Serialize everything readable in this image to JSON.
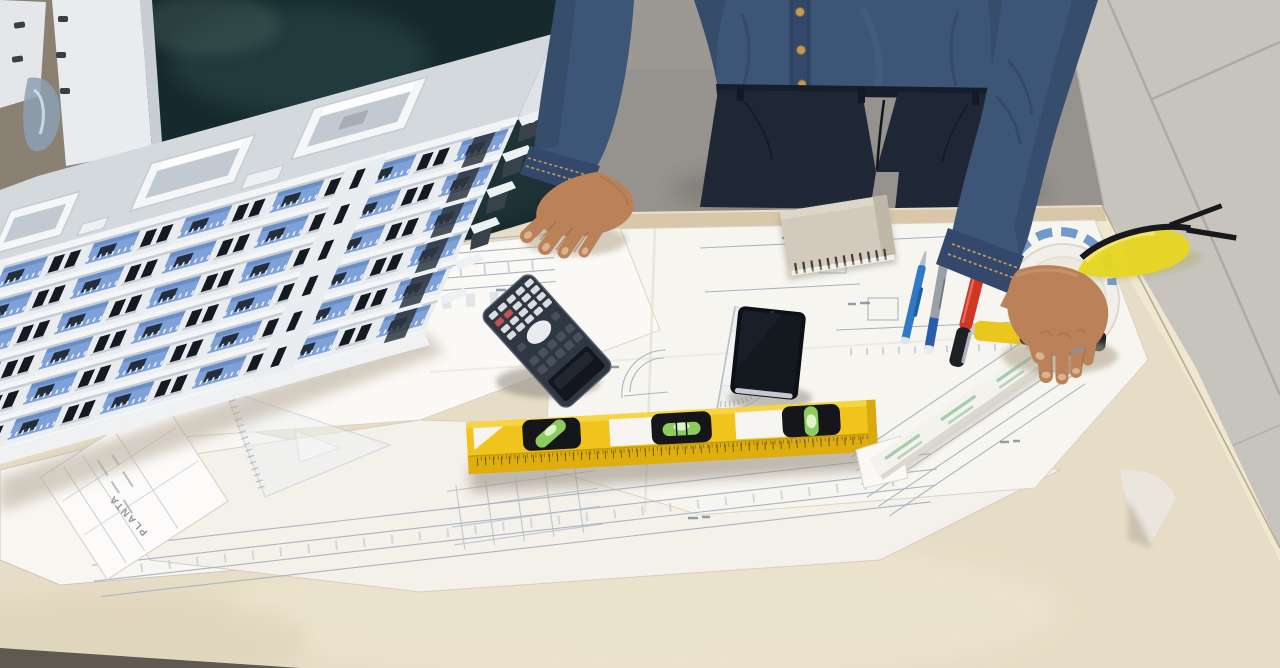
{
  "scene": {
    "type": "photograph",
    "setting": "architecture studio worktable, top-down oblique view",
    "person": {
      "description": "architect standing behind table, cropped at shoulders",
      "clothing": [
        "denim shirt with gold buttons",
        "dark navy trousers"
      ],
      "left_hand": "resting flat on blueprint",
      "right_hand": "gripping white ruler end"
    },
    "objects": [
      {
        "id": "building-model",
        "label": "white and blue apartment building scale model",
        "colors": [
          "#e9ecef",
          "#7da1d8",
          "#151a22"
        ]
      },
      {
        "id": "blueprints",
        "label": "overlapping architectural blueprint sheets",
        "color": "#f7f5f0"
      },
      {
        "id": "title-block-sheet",
        "label": "blueprint sheet with rotated title block",
        "text": "PLANTA"
      },
      {
        "id": "notepad",
        "label": "spiral notepad, binding at bottom edge",
        "color": "#d2cbbd"
      },
      {
        "id": "calculator",
        "label": "scientific calculator rotated upside-down",
        "color": "#2f3743"
      },
      {
        "id": "smartphone",
        "label": "black smartphone, screen off",
        "color": "#0d1015"
      },
      {
        "id": "protractor",
        "label": "transparent semicircular protractor under phone",
        "color": "#e8ecf0"
      },
      {
        "id": "spirit-level",
        "label": "yellow spirit level with 3 green vials and ruler edge",
        "vial_count": 3,
        "color": "#f1c41d"
      },
      {
        "id": "white-ruler",
        "label": "white ruler with green stripes held diagonally",
        "color": "#f4f2ec"
      },
      {
        "id": "set-square",
        "label": "transparent triangle set square on blueprints",
        "color": "#eef1f4"
      },
      {
        "id": "mechanical-pencil",
        "label": "blue mechanical pencil",
        "color": "#2f79c6"
      },
      {
        "id": "gray-pen",
        "label": "gray pen with blue grip and white cap end",
        "color": "#99a0a8"
      },
      {
        "id": "red-marker",
        "label": "red marker with black cap",
        "color": "#cf3722"
      },
      {
        "id": "utility-knife",
        "label": "yellow and black utility knife under hand",
        "color": "#e9c71c"
      },
      {
        "id": "tape-measure",
        "label": "white round tape measure partly under hand",
        "color": "#f1efe9"
      },
      {
        "id": "safety-glasses",
        "label": "yellow-lens safety glasses with black arms",
        "color": "#e7d622"
      },
      {
        "id": "chalkboard",
        "label": "dark green-black board behind model",
        "color": "#16292c"
      },
      {
        "id": "plywood-table",
        "label": "light plywood drafting table",
        "color": "#e7ddc6"
      },
      {
        "id": "tile-floor",
        "label": "light gray tiled floor, right side",
        "color": "#c7c4be"
      },
      {
        "id": "concrete-floor",
        "label": "gray concrete floor behind person",
        "color": "#96928d"
      }
    ]
  },
  "texts": {
    "blueprint_title": "PLANTA"
  },
  "palette": {
    "wall": "#8a8172",
    "board": "#16292c",
    "floor": "#96928d",
    "tile": "#c7c4be",
    "grout": "#aeaaa3",
    "table": "#e7ddc6",
    "table_edge": "#f0e7d1",
    "wood": "#d8c8a9",
    "paper": "#f7f5f0",
    "line": "#aab4c0",
    "model_white": "#e9ecef",
    "model_roof": "#d4d9dd",
    "model_blue": "#7da1d8",
    "model_window": "#151a22",
    "denim": "#3d5677",
    "denim_dark": "#33486b",
    "pants": "#1f2736",
    "skin": "#bb8259",
    "skin_dark": "#9a6a44",
    "level_y": "#f1c41d",
    "level_yd": "#dfae0e",
    "vial": "#8ccb5e",
    "ruler": "#f4f2ec",
    "ruler_green": "#a3cdad",
    "calc": "#2f3743",
    "screen": "#13171d",
    "key": "#d9dce1",
    "key_red": "#c25055",
    "key_dark": "#47505d",
    "pen_blue": "#2f79c6",
    "pen_gray": "#99a0a8",
    "marker_red": "#cf3722",
    "cap_black": "#1d2025",
    "knife": "#e9c71c",
    "glasses": "#e7d622",
    "notepad": "#d2cbbd",
    "gold": "#c29a58"
  }
}
